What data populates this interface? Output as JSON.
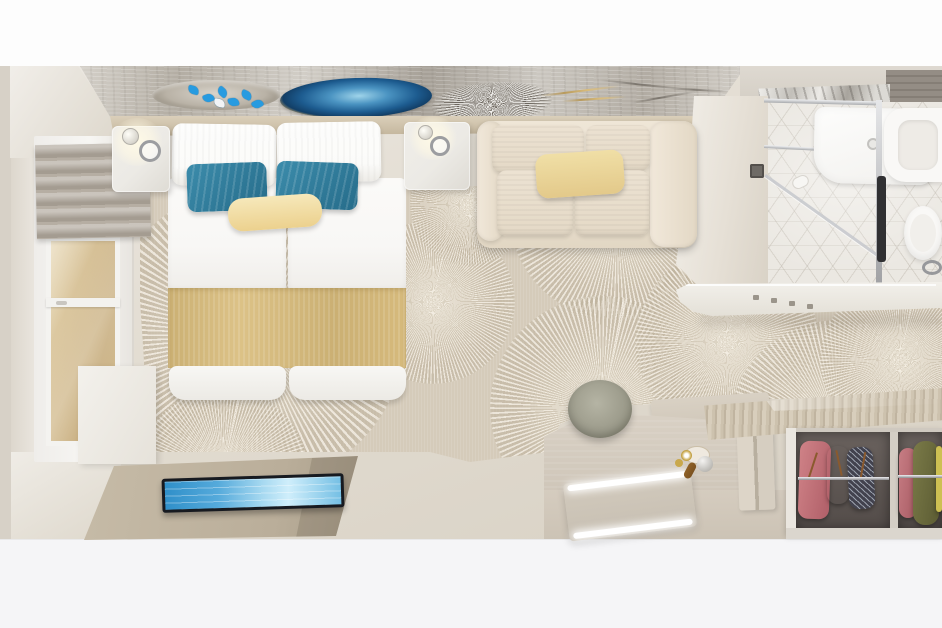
{
  "meta": {
    "title": "Top-down 3D rendering of a hotel cabin interior",
    "view": "bird's-eye interior render",
    "visible_text": "none"
  },
  "colors": {
    "bg_top": "#fdfdfd",
    "bg_bottom": "#f5f5f7",
    "wall_edge": "#d7d1c7",
    "butterfly_blue": "#279be0",
    "geode_blue_deep": "#123e66",
    "geode_blue_light": "#9fd4ea",
    "carpet_base": "#d5cbba",
    "pillow_white": "#fbfbf9",
    "pillow_teal_1": "#3c8cab",
    "pillow_teal_2": "#266c8a",
    "pillow_cream_1": "#f6e8ba",
    "pillow_cream_2": "#ecd18e",
    "runner_gold_1": "#dcc287",
    "runner_gold_2": "#cbb073",
    "duvet_white": "#f8f7f5",
    "nightstand_marble": "#eceae5",
    "chrome": "#9c9da0",
    "sofa_cream_1": "#ece2d2",
    "sofa_cream_2": "#e2d7c4",
    "sofa_pillow_yellow": "#f0dfa6",
    "shade_greige": "#b6aea3",
    "tv_frame": "#171a20",
    "tv_screen_1": "#2f8fc9",
    "tv_screen_2": "#cfeefb",
    "mat_tan_1": "#c6bba7",
    "mat_tan_2": "#a79c88",
    "desk_wood_1": "#d9d1c5",
    "desk_wood_2": "#cfc6b9",
    "stool_sage_1": "#b5b4a4",
    "stool_sage_2": "#85846f",
    "led_white": "#ffffff",
    "wardrobe_top_1": "#cdc2ae",
    "wardrobe_top_2": "#d8cebc",
    "wardrobe_inner_1": "#6a625e",
    "wardrobe_inner_2": "#534c49",
    "cloth_pink": "#cf8287",
    "cloth_rose_dark": "#8c4a50",
    "cloth_navy": "#42424e",
    "cloth_olive_1": "#7a7a48",
    "cloth_olive_2": "#5c5c33",
    "cloth_yellow": "#cdc052",
    "hanger_wood": "#8a5a2e",
    "tile_1": "#ebe8e2",
    "shower_column": "#303032",
    "fixture_white": "#f9f8f6",
    "counter_white_1": "#f4f2ed",
    "counter_white_2": "#e3dfd6",
    "cabinet_gray_1": "#948d85",
    "cabinet_gray_2": "#6b655f",
    "gold_accent": "#c9a84c",
    "amber_bottle": "#7c5220"
  },
  "scene": {
    "rooms": [
      {
        "name": "bedroom",
        "objects": [
          "wall-art-butterfly-plate",
          "wall-art-blue-geode",
          "wall-art-silver-starburst",
          "headboard-shelf",
          "double-bed",
          "white-pillows",
          "teal-accent-pillows",
          "cream-lumbar-pillow",
          "gold-bed-runner",
          "left-nightstand",
          "right-nightstand",
          "wall-sconce-lamps",
          "window-with-roman-shade",
          "sunburst-pattern-carpet",
          "cream-loveseat-sofa",
          "yellow-lumbar-pillow",
          "wall-mounted-tv",
          "tv-console-mat",
          "vanity-desk",
          "led-lit-mirror",
          "round-sage-stool",
          "tea-set-tray"
        ]
      },
      {
        "name": "bathroom",
        "objects": [
          "glass-shower-enclosure",
          "shower-tray",
          "shower-column",
          "geometric-tile-floor",
          "vanity-counter-with-basin",
          "toilet",
          "chrome-towel-ring",
          "toilet-paper-holder",
          "wall-switch-panel",
          "overhead-gray-shelf",
          "counter-ledge-with-hooks"
        ]
      },
      {
        "name": "wardrobe",
        "objects": [
          "slatted-wood-top",
          "open-closet-compartment-left",
          "open-closet-compartment-right",
          "chrome-hanging-rails",
          "pink-garment",
          "floral-garment",
          "patterned-navy-garment",
          "olive-garment",
          "yellow-garment",
          "wooden-hangers"
        ]
      }
    ]
  }
}
